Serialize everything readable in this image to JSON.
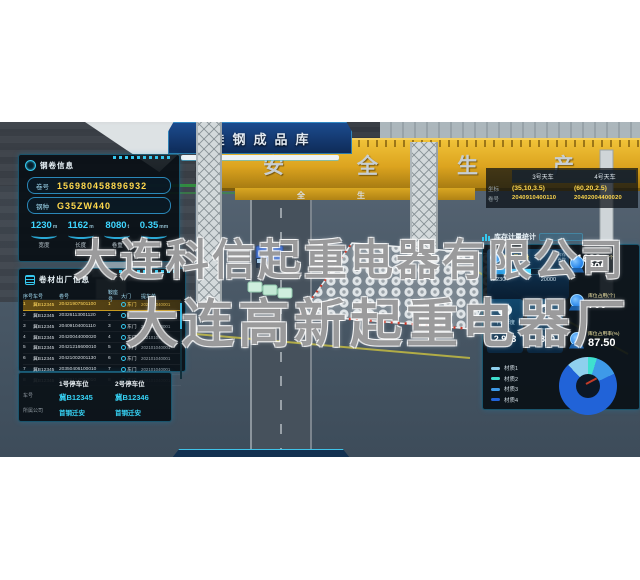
{
  "banner": {
    "title": "硅钢成品库"
  },
  "crane_beam": {
    "slogan": [
      "安",
      "全",
      "生",
      "产"
    ],
    "slogan_far": [
      "全",
      "生",
      "产"
    ]
  },
  "watermark": {
    "line1": "大连科信起重电器有限公司",
    "line2": "大连高新起重电器厂"
  },
  "coil_info": {
    "title": "钢卷信息",
    "fields": [
      {
        "label": "卷号",
        "value": "156980458896932"
      },
      {
        "label": "钢种",
        "value": "G35ZW440"
      }
    ],
    "stats": [
      {
        "value": "1230",
        "unit": "m",
        "label": "宽度"
      },
      {
        "value": "1162",
        "unit": "m",
        "label": "长度"
      },
      {
        "value": "8080",
        "unit": "t",
        "label": "卷重"
      },
      {
        "value": "0.35",
        "unit": "mm",
        "label": "厚度"
      }
    ]
  },
  "shipment": {
    "title": "卷材出厂信息",
    "columns": [
      "序号",
      "车号",
      "卷号",
      "鞍座号",
      "大门",
      "提车单"
    ],
    "rows": [
      {
        "no": "1",
        "truck": "冀B12345",
        "coil": "20421907501100",
        "saddle": "1",
        "gate": "东门",
        "ticket": "202101040001"
      },
      {
        "no": "2",
        "truck": "冀B12345",
        "coil": "20326113001120",
        "saddle": "2",
        "gate": "东门",
        "ticket": "202101040001"
      },
      {
        "no": "3",
        "truck": "冀B12345",
        "coil": "20409104001110",
        "saddle": "3",
        "gate": "东门",
        "ticket": "202101040001"
      },
      {
        "no": "4",
        "truck": "冀B12345",
        "coil": "20420044000020",
        "saddle": "4",
        "gate": "东门",
        "ticket": "202101040001"
      },
      {
        "no": "5",
        "truck": "冀B12345",
        "coil": "20421216600010",
        "saddle": "5",
        "gate": "东门",
        "ticket": "202101040001"
      },
      {
        "no": "6",
        "truck": "冀B12345",
        "coil": "20421002001130",
        "saddle": "6",
        "gate": "东门",
        "ticket": "202101040001"
      },
      {
        "no": "7",
        "truck": "冀B12345",
        "coil": "20350406100010",
        "saddle": "7",
        "gate": "东门",
        "ticket": "202101040001"
      },
      {
        "no": "8",
        "truck": "冀B12345",
        "coil": "20326114000010",
        "saddle": "8",
        "gate": "东门",
        "ticket": "202101040001"
      }
    ]
  },
  "parking": {
    "labels": {
      "truck": "车号",
      "company": "所属公司"
    },
    "slots": [
      {
        "title": "1号停车位",
        "truck_no": "冀B12345",
        "company": "首钢迁安"
      },
      {
        "title": "2号停车位",
        "truck_no": "冀B12346",
        "company": "首钢迁安"
      }
    ]
  },
  "cranes": {
    "col1": "3号天车",
    "col2": "4号天车",
    "rows": [
      {
        "label": "坐标",
        "v1": "(35,10,3.5)",
        "v2": "(60,20,2.5)"
      },
      {
        "label": "卷号",
        "v1": "2040910400110",
        "v2": "20402004400020"
      }
    ]
  },
  "stock": {
    "section_title": "库存计量统计",
    "throughput": {
      "title": "库存吞吐量",
      "side_label_1": "库存",
      "side_label_2": "卷数",
      "count": "1683",
      "progress_current": "12230",
      "progress_max": "20000",
      "progress_pct": 61
    },
    "tiles": [
      {
        "label": "平均厚度",
        "unit": "(mm)",
        "value": "2.983"
      },
      {
        "label": "平均宽度",
        "unit": "(mm)",
        "value": "1870"
      }
    ],
    "kpis": [
      {
        "label": "库位总数(个)",
        "value": "800"
      },
      {
        "label": "库位占用(个)",
        "value": "700"
      },
      {
        "label": "库位占用率(%)",
        "value": "87.50"
      }
    ]
  },
  "chart_data": {
    "type": "pie",
    "title": "材质占比",
    "labels": [
      "材质1",
      "材质2",
      "材质3",
      "材质4"
    ],
    "values": [
      12,
      5,
      13,
      70
    ],
    "colors": [
      "#8fd0ee",
      "#3fe0cf",
      "#3e9ae8",
      "#2163d8"
    ],
    "legend_position": "left"
  },
  "theme": {
    "accent": "#35c8ef",
    "highlight": "#ffd84d",
    "value_cyan": "#36d2f5"
  }
}
